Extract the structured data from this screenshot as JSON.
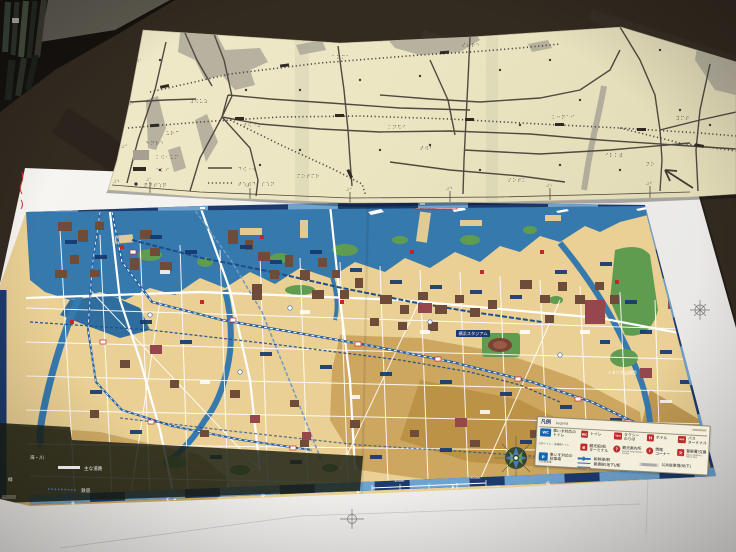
{
  "colors": {
    "table": "#2e261d",
    "braille_paper": "#ece6c4",
    "braille_ink": "#4f4940",
    "map_land": "#ead094",
    "map_water": "#3679ad",
    "map_border_navy": "#1d3a6e",
    "legend_red": "#bf2b2b",
    "legend_blue": "#1565b0"
  },
  "braille_map": {
    "legend": {
      "title_braille": "⠓⠝⠗⠑",
      "items": [
        {
          "symbol": "gray-area-swatch",
          "braille": "⠅⠪⠂⠥⠍"
        },
        {
          "symbol": "station-bar-swatch",
          "braille": "⠑⠅⠊"
        },
        {
          "symbol": "poi-dot-swatch",
          "braille": "⠟⠙⠞⠱⠟"
        },
        {
          "symbol": "road-line-swatch",
          "braille": "⠙⠪⠐⠺"
        },
        {
          "symbol": "railway-dotted-swatch",
          "braille": "⠞⠱⠞⠙⠂⠎⠱⠝"
        }
      ]
    },
    "labels": [
      "⠽⠪⠥⠵",
      "⠞⠪⠐⠥",
      "⠍⠕⠞⠍⠗",
      "⠅⠝⠫⠊",
      "⠎⠦⠗⠑",
      "⠁⠵⠍⠁",
      "⠅⠒⠝⠁⠊",
      "⠊⠇⠅⠾",
      "⠽⠍⠞",
      "⠥⠗⠉",
      "⠞⠺⠃",
      "⠎⠕⠞⠅"
    ],
    "left_edge_marks": [
      "⠼⠁",
      "⠼⠃",
      "⠼⠉",
      "⠼⠙"
    ],
    "bottom_edge_marks": [
      "⠼⠁",
      "⠼⠃",
      "⠼⠉",
      "⠼⠙",
      "⠼⠑",
      "⠼⠋"
    ],
    "north_label": "⠝⠕"
  },
  "city_map": {
    "labels": {
      "osanbashi1": "横浜港大さん橋",
      "osanbashi2": "国際客船ターミナル",
      "stadium": "横浜スタジアム",
      "italia_garden": "イタリア山庭園"
    },
    "grid_letters": [
      "B",
      "C",
      "D",
      "E",
      "F",
      "G"
    ],
    "grid_number": "4",
    "scale_100": "100m",
    "scale_500": "500m",
    "quick_legend": {
      "sea": "海・川",
      "green": "緑",
      "main_road": "主な道路",
      "rail": "鉄道"
    },
    "legend": {
      "title": "凡例",
      "title_en": "Legend",
      "wheelchair_toilet": {
        "glyph": "WC",
        "label": "車いす対応の\nトイレ",
        "sub": "公共トイレ・多機能トイレ"
      },
      "toilet": {
        "glyph": "WC",
        "label": "トイレ"
      },
      "taxi": {
        "glyph": "TAXI",
        "label": "タクシー\nのりば"
      },
      "hotel": {
        "glyph": "H",
        "label": "ホテル"
      },
      "bus": {
        "glyph": "BUS",
        "label": "バス\nターミナル"
      },
      "ship": {
        "glyph": "船",
        "label": "観光船/船\nターミナル"
      },
      "info_center": {
        "glyph": "?",
        "label": "観光案内所",
        "sub": "Tourist Information Center"
      },
      "info_corner": {
        "glyph": "i",
        "label": "情報\nコーナー"
      },
      "police": {
        "glyph": "交",
        "label": "警察署/交番",
        "sub": "Police Station / Police Box"
      },
      "wheelchair_parking": {
        "glyph": "P",
        "label": "車いす対応の\n駐車場",
        "sub": "公共駐車場"
      },
      "shinkansen": {
        "label": "新幹線/駅"
      },
      "local_line": {
        "label": "普通線(地下)/駅"
      },
      "underground_parking": {
        "label": "公共駐車場(地下)"
      }
    }
  }
}
